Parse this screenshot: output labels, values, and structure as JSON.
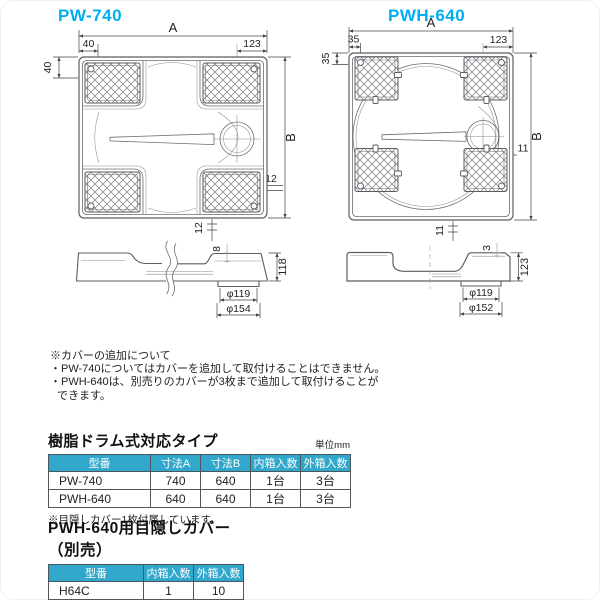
{
  "pw740": {
    "title": "PW-740",
    "top": {
      "a": "A",
      "offset_top_left": "40",
      "offset_top_right": "123",
      "offset_left": "40",
      "b": "B",
      "rim_right": "12",
      "rim_bottom": "12"
    },
    "side": {
      "rim": "8",
      "height": "118",
      "drain_inner": "φ119",
      "drain_outer": "φ154"
    }
  },
  "pwh640": {
    "title": "PWH-640",
    "top": {
      "a": "A",
      "offset_top_left": "35",
      "offset_top_right": "123",
      "offset_left": "35",
      "b": "B",
      "rim_right": "11",
      "rim_bottom": "11"
    },
    "side": {
      "rim": "3",
      "height": "123",
      "drain_inner": "φ119",
      "drain_outer": "φ152"
    }
  },
  "notes": {
    "title": "※カバーの追加について",
    "line1": "・PW-740についてはカバーを追加して取付けることはできません。",
    "line2": "・PWH-640は、別売りのカバーが3枚まで追加して取付けることが",
    "line3": "できます。"
  },
  "table1": {
    "title": "樹脂ドラム式対応タイプ",
    "unit": "単位mm",
    "headers": [
      "型番",
      "寸法A",
      "寸法B",
      "内箱入数",
      "外箱入数"
    ],
    "rows": [
      [
        "PW-740",
        "740",
        "640",
        "1台",
        "3台"
      ],
      [
        "PWH-640",
        "640",
        "640",
        "1台",
        "3台"
      ]
    ],
    "note": "※目隠しカバー1枚付属しています。"
  },
  "table2": {
    "title": "PWH-640用目隠しカバー（別売）",
    "headers": [
      "型番",
      "内箱入数",
      "外箱入数"
    ],
    "rows": [
      [
        "H64C",
        "1",
        "10"
      ]
    ],
    "note": "※カバーのみ追加対応可能です。"
  },
  "colors": {
    "accent": "#00AEEF",
    "table_header_bg": "#31A8CB",
    "line": "#5a5e62"
  }
}
